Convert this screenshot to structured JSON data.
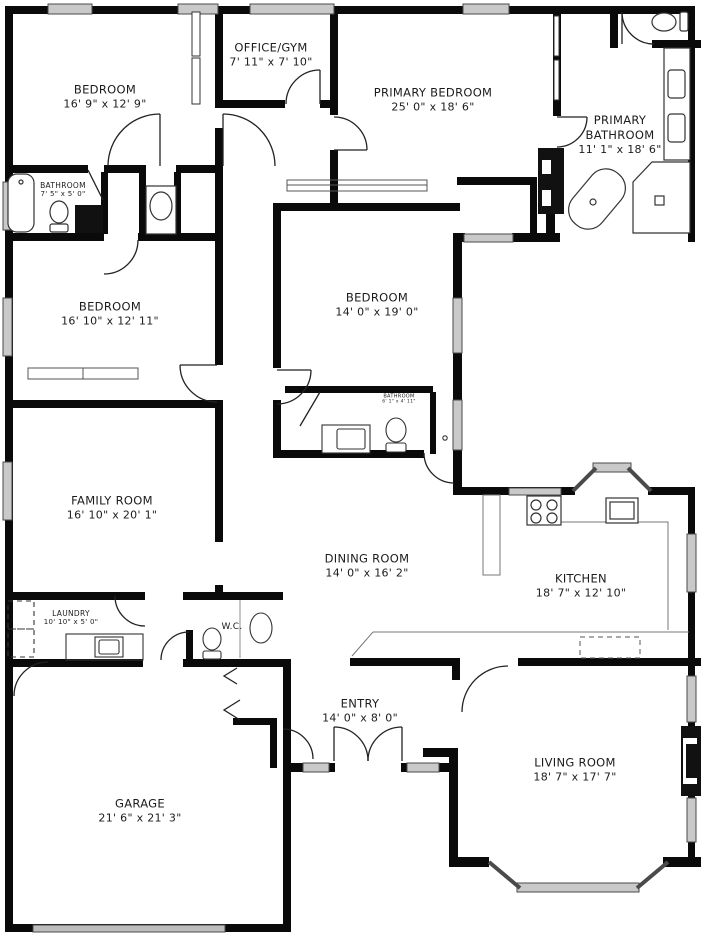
{
  "plan": {
    "wall_color": "#0a0a0a",
    "window_color": "#c9c9c9",
    "rooms": {
      "bedroom1": {
        "name": "BEDROOM",
        "dims": "16' 9\" x 12' 9\""
      },
      "office": {
        "name": "OFFICE/GYM",
        "dims": "7' 11\" x 7' 10\""
      },
      "primary_bed": {
        "name": "PRIMARY BEDROOM",
        "dims": "25' 0\" x 18' 6\""
      },
      "primary_bath": {
        "name": "PRIMARY BATHROOM",
        "dims": "11' 1\" x 18' 6\""
      },
      "bathroom1": {
        "name": "BATHROOM",
        "dims": "7' 5\" x 5' 0\""
      },
      "bedroom2": {
        "name": "BEDROOM",
        "dims": "16' 10\" x 12' 11\""
      },
      "bedroom3": {
        "name": "BEDROOM",
        "dims": "14' 0\" x 19' 0\""
      },
      "bathroom3": {
        "name": "BATHROOM",
        "dims": "6' 1\" x 4' 11\""
      },
      "family": {
        "name": "FAMILY ROOM",
        "dims": "16' 10\" x 20' 1\""
      },
      "dining": {
        "name": "DINING ROOM",
        "dims": "14' 0\" x 16' 2\""
      },
      "kitchen": {
        "name": "KITCHEN",
        "dims": "18' 7\" x 12' 10\""
      },
      "laundry": {
        "name": "LAUNDRY",
        "dims": "10' 10\" x 5' 0\""
      },
      "wc": {
        "name": "W.C.",
        "dims": ""
      },
      "entry": {
        "name": "ENTRY",
        "dims": "14' 0\" x 8' 0\""
      },
      "garage": {
        "name": "GARAGE",
        "dims": "21' 6\" x 21' 3\""
      },
      "living": {
        "name": "LIVING ROOM",
        "dims": "18' 7\" x 17' 7\""
      }
    }
  }
}
